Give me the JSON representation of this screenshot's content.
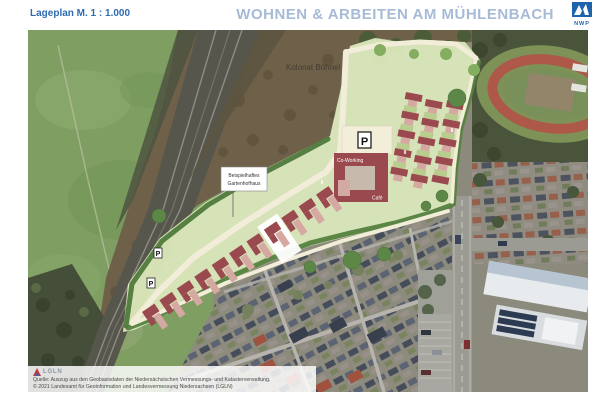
{
  "header": {
    "scale_label": "Lageplan M. 1 : 1.000",
    "title": "WOHNEN & ARBEITEN AM MÜHLENBACH",
    "logo_text": "NWP"
  },
  "map": {
    "area_label": "Kolonat Böhnel",
    "example_label": {
      "line1": "Beispielhaftes",
      "line2": "Gartenhofhaus"
    },
    "coworking_label": "Co-Working",
    "cafe_label": "Café",
    "parking_symbol": "P",
    "unit_marker": "II"
  },
  "footer": {
    "logo_text": "LGLN",
    "line1": "Quelle: Auszug aus den Geobasisdaten der Niedersächsischen Vermessungs- und Katasterverwaltung,",
    "line2": "© 2021 Landesamt für Geoinformation und Landesvermessung Niedersachsen (LGLN)"
  },
  "colors": {
    "header_blue": "#2e6cb2",
    "title_blue": "#a7bad6",
    "logo_blue": "#1f63ad",
    "building_red": "#9a4a4e",
    "building_pink": "#d5a8a2",
    "site_green": "#d9e5b9",
    "path_cream": "#f2edd8",
    "hedge_green": "#55813f",
    "track_red": "#ad5848"
  }
}
